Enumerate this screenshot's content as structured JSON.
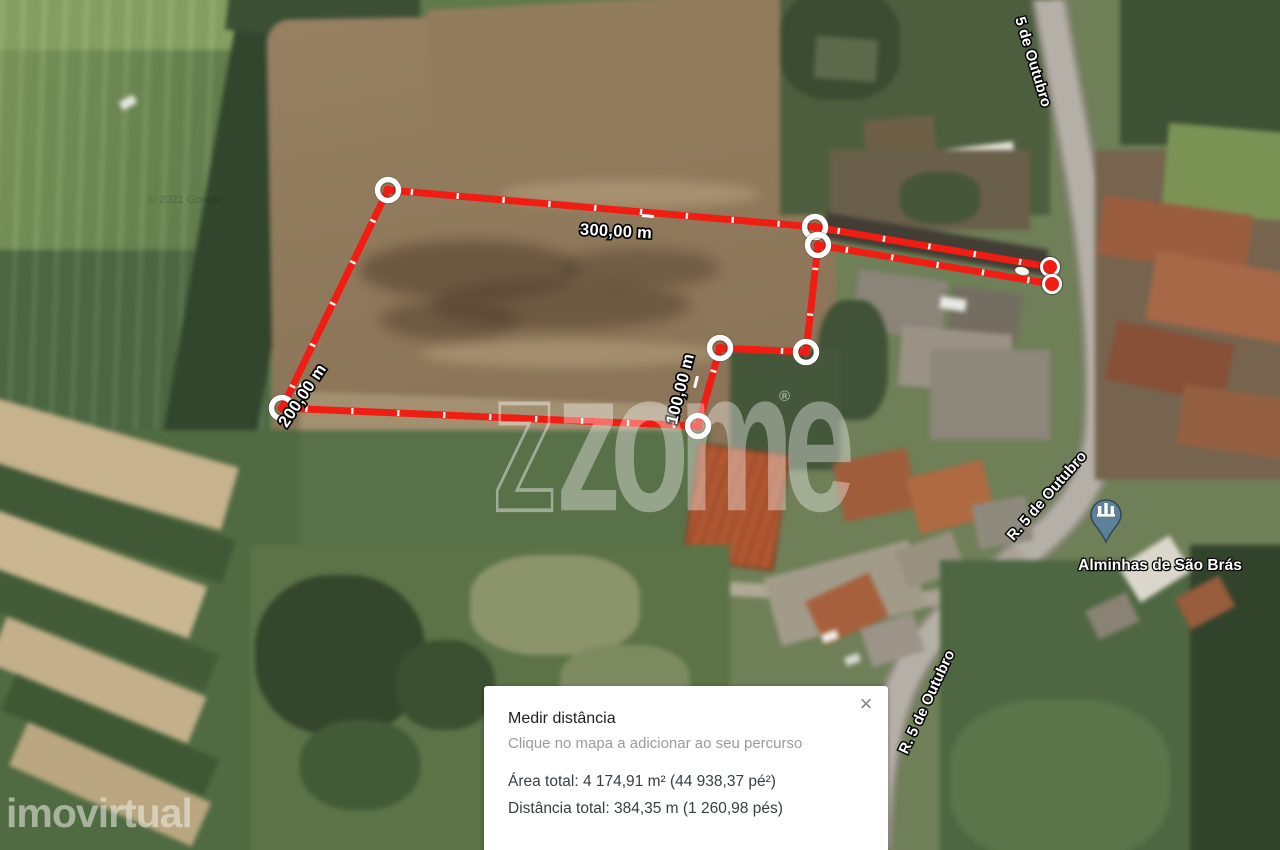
{
  "watermarks": {
    "center_logo": "zome",
    "center_logo_outline_letter": "z",
    "registered_mark": "®",
    "bottom_left_logo": "imovirtual",
    "copyright": "© 2021 Google"
  },
  "roads": {
    "labels": [
      {
        "text": "5 de Outubro",
        "x": 1033,
        "y": 62,
        "rotate": 73
      },
      {
        "text": "R. 5 de Outubro",
        "x": 1047,
        "y": 496,
        "rotate": -49
      },
      {
        "text": "R. 5 de Outubro",
        "x": 927,
        "y": 702,
        "rotate": -65
      }
    ]
  },
  "poi": {
    "name": "Alminhas de São Brás",
    "icon": "shrine-pin-icon",
    "pin_color": "#5f8099",
    "pin_border_color": "#2e4756",
    "x": 1106,
    "y": 522,
    "label_x": 1160,
    "label_y": 566
  },
  "measurement": {
    "tool_line_color": "#f11d12",
    "path_px": [
      [
        388,
        190
      ],
      [
        815,
        227
      ],
      [
        1050,
        267
      ],
      [
        1052,
        284
      ],
      [
        818,
        245
      ],
      [
        806,
        352
      ],
      [
        720,
        348
      ],
      [
        698,
        426
      ],
      [
        282,
        408
      ]
    ],
    "cap_indices": [
      2,
      3
    ],
    "cap_oval": {
      "x": 1022,
      "y": 271,
      "rx": 7,
      "ry": 4,
      "rotate": 12
    },
    "segment_labels": [
      {
        "text": "300,00 m",
        "x": 616,
        "y": 232,
        "rotate": 3
      },
      {
        "text": "100,00 m",
        "x": 681,
        "y": 389,
        "rotate": -76
      },
      {
        "text": "200,00 m",
        "x": 303,
        "y": 396,
        "rotate": -56
      }
    ],
    "major_ticks": [
      {
        "x": 648,
        "y": 216,
        "rotate": 95
      },
      {
        "x": 696,
        "y": 382,
        "rotate": 14
      },
      {
        "x": 299,
        "y": 389,
        "rotate": 28
      }
    ]
  },
  "panel": {
    "title": "Medir distância",
    "subtitle": "Clique no mapa a adicionar ao seu percurso",
    "area_total": "Área total: 4 174,91 m² (44 938,37 pé²)",
    "distance_total": "Distância total: 384,35 m (1 260,98 pés)",
    "close_glyph": "×"
  }
}
